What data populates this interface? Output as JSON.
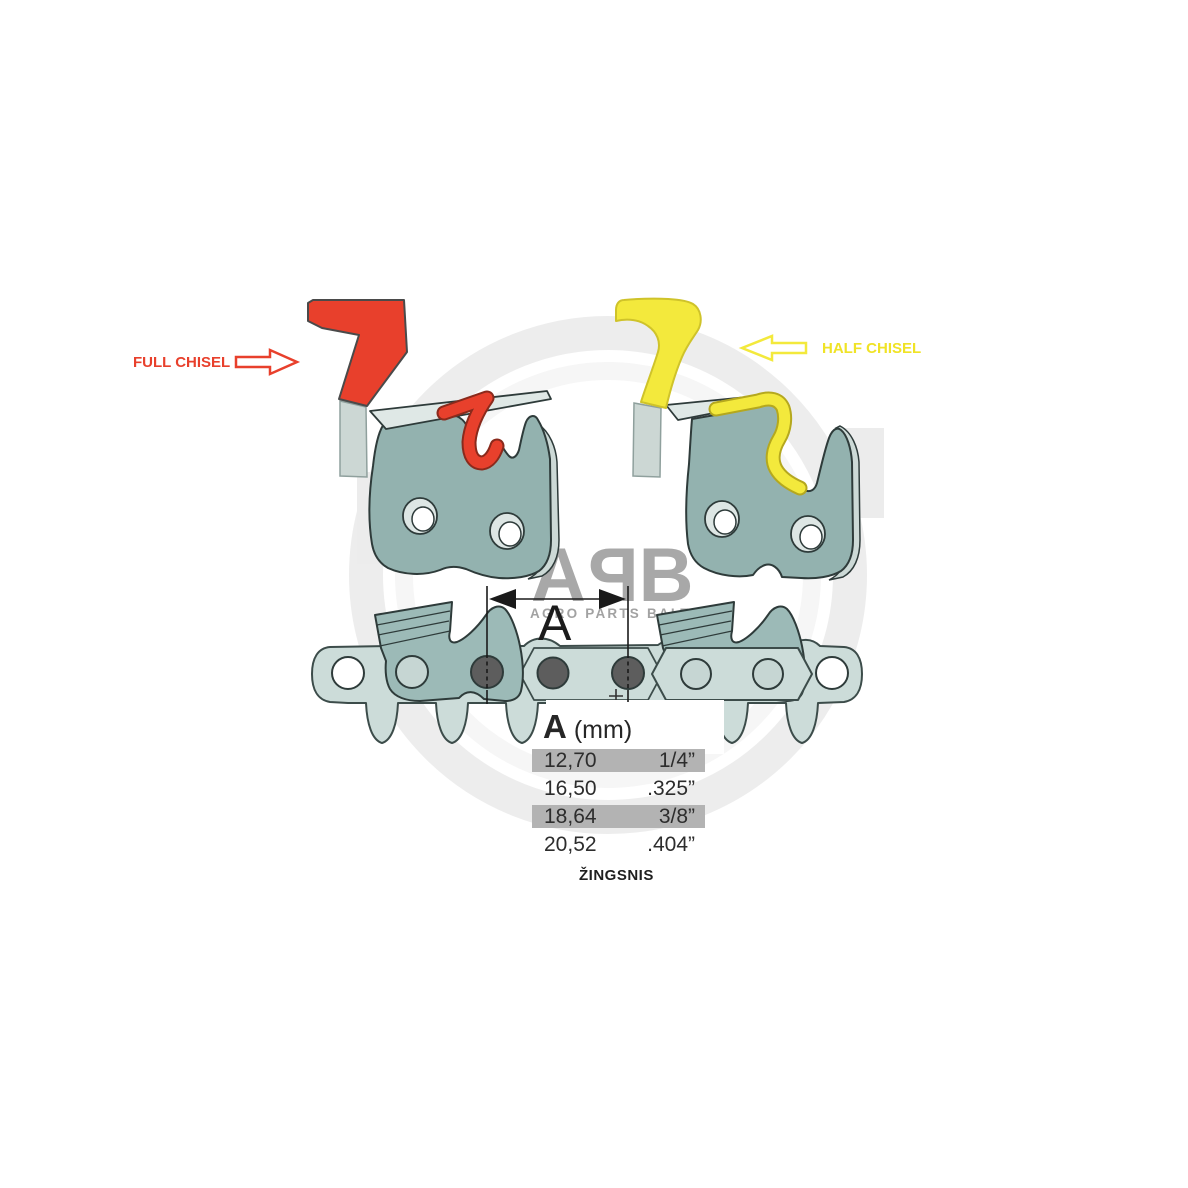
{
  "labels": {
    "full_chisel": "FULL CHISEL",
    "half_chisel": "HALF CHISEL",
    "dimension_letter": "A"
  },
  "table": {
    "header": {
      "symbol": "A",
      "unit": "(mm)"
    },
    "rows": [
      {
        "mm": "12,70",
        "inch": "1/4”",
        "highlighted": true
      },
      {
        "mm": "16,50",
        "inch": ".325”",
        "highlighted": false
      },
      {
        "mm": "18,64",
        "inch": "3/8”",
        "highlighted": true
      },
      {
        "mm": "20,52",
        "inch": ".404”",
        "highlighted": false
      }
    ],
    "caption": "ŽINGSNIS"
  },
  "watermark": {
    "letters": [
      "A",
      "P",
      "B"
    ],
    "subtitle": "AGRO PARTS BALTIJA"
  },
  "colors": {
    "red": "#e8402c",
    "yellow": "#f3e93c",
    "chain_light": "#ccdcd9",
    "cutter_teal": "#93b2af",
    "cutter_mid": "#9cbab7",
    "plate": "#dfe8e6",
    "rivet": "#5d5d5d",
    "row_highlight": "#b3b3b3",
    "watermark_gray": "#a8a8a8"
  }
}
